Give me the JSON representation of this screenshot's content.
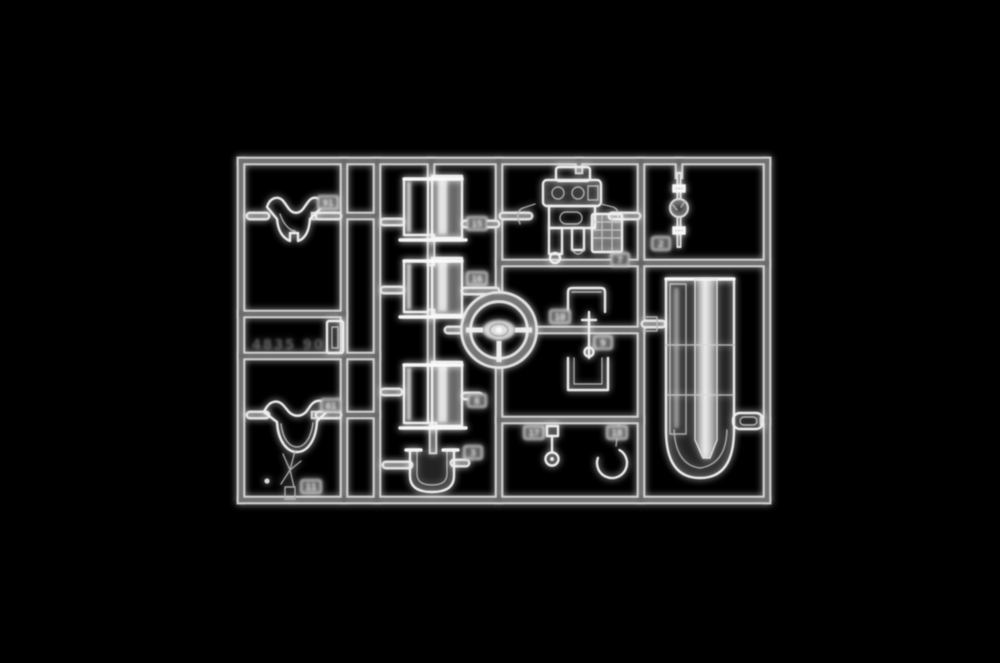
{
  "scene": {
    "description": "Monochrome product photo of a transparent injection-molded model kit sprue (clear parts tree) centered on a solid black background",
    "background_color": "#000000",
    "plastic_edge_color": "#e4e4e4",
    "mold_marking": "4835 90"
  },
  "parts": {
    "windscreen_upper": {
      "label": "upper windscreen",
      "tag": "91"
    },
    "windscreen_lower": {
      "label": "lower windscreen",
      "tag": "61"
    },
    "star_fitting": {
      "label": "small star fitting",
      "tag": "11"
    },
    "duct_1": {
      "label": "intake duct 1",
      "tag": "15"
    },
    "duct_2": {
      "label": "intake duct 2",
      "tag": "16"
    },
    "duct_3": {
      "label": "intake duct 3",
      "tag": "8"
    },
    "u_windscreen": {
      "label": "U-shaped screen",
      "tag": "3"
    },
    "instrument_panel": {
      "label": "instrument panel cluster",
      "tag": "7"
    },
    "sight": {
      "label": "sight / small lens pin",
      "tag": "2"
    },
    "plate": {
      "label": "rectangular plate",
      "tag": "10"
    },
    "lever": {
      "label": "lever with base",
      "tag": "9"
    },
    "knob": {
      "label": "knob with round foot",
      "tag": "17"
    },
    "ring": {
      "label": "open ring",
      "tag": "18"
    },
    "steering_wheel": {
      "label": "steering wheel"
    },
    "canopy_cylinder": {
      "label": "large cylindrical clear part"
    }
  }
}
